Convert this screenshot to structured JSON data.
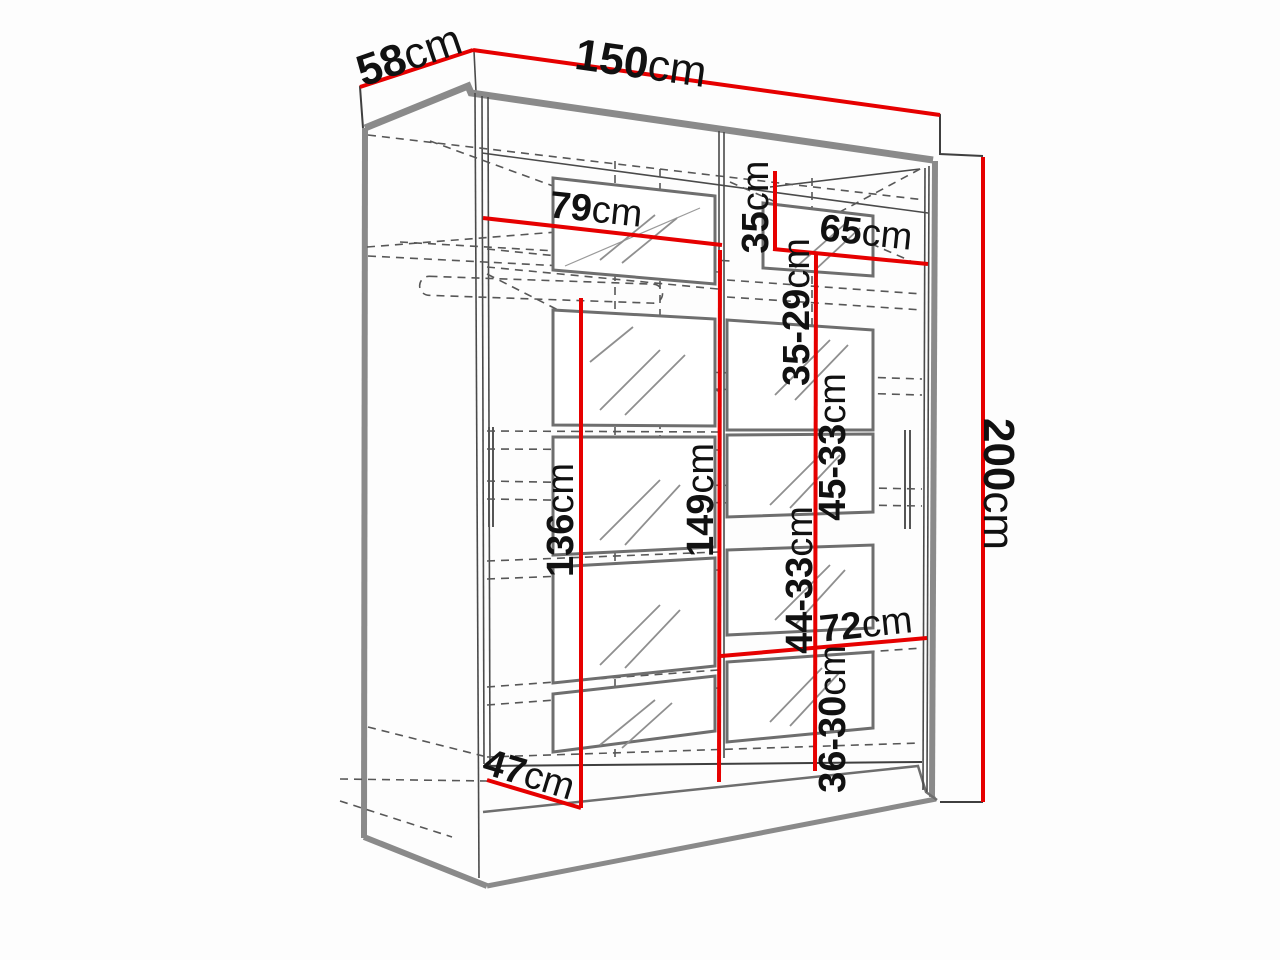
{
  "diagram": {
    "type": "wardrobe-dimension-diagram",
    "colors": {
      "dimension_line": "#e60000",
      "outline": "#3f3f3f",
      "panel_edge": "#8a8a8a"
    },
    "dimensions": {
      "width": {
        "value": "150",
        "unit": "cm"
      },
      "depth": {
        "value": "58",
        "unit": "cm"
      },
      "height": {
        "value": "200",
        "unit": "cm"
      },
      "left_section_width": {
        "value": "79",
        "unit": "cm"
      },
      "top_shelf_height": {
        "value": "35",
        "unit": "cm"
      },
      "right_section_width": {
        "value": "65",
        "unit": "cm"
      },
      "shelf_gap_1": {
        "value": "35-29",
        "unit": "cm"
      },
      "shelf_gap_2": {
        "value": "45-33",
        "unit": "cm"
      },
      "left_section_height": {
        "value": "136",
        "unit": "cm"
      },
      "middle_height": {
        "value": "149",
        "unit": "cm"
      },
      "shelf_gap_3": {
        "value": "44-33",
        "unit": "cm"
      },
      "bottom_shelf_width": {
        "value": "72",
        "unit": "cm"
      },
      "shelf_gap_4": {
        "value": "36-30",
        "unit": "cm"
      },
      "base_depth": {
        "value": "47",
        "unit": "cm"
      }
    }
  }
}
